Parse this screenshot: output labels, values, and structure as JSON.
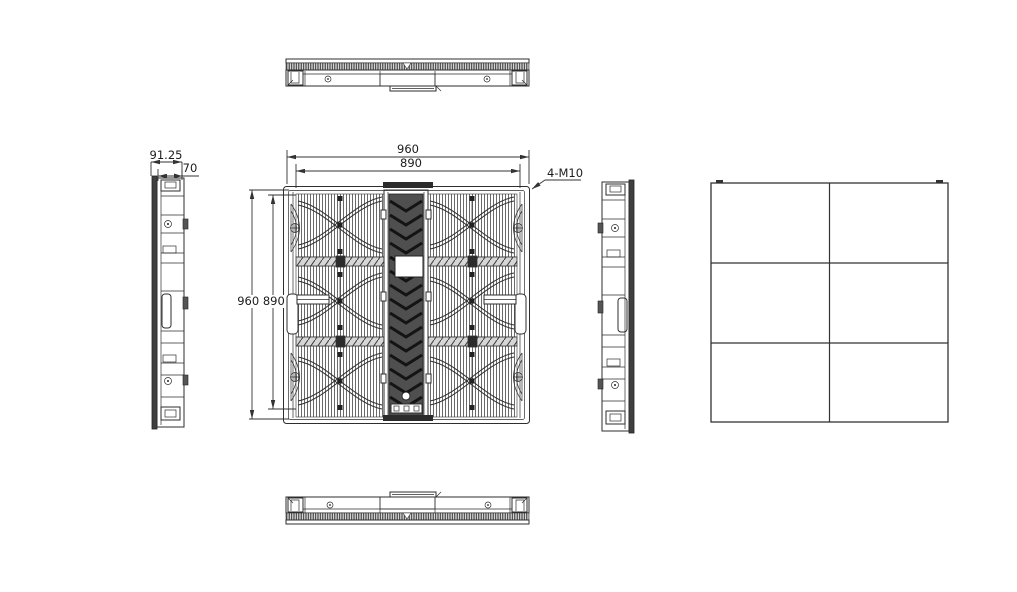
{
  "drawing": {
    "background": "#ffffff",
    "line_color": "#2e2e2e",
    "annotations": {
      "front_width_outer": "960",
      "front_width_inner": "890",
      "front_height_pair": "960 890",
      "mount_callout": "4-M10",
      "side_depth_overall": "91.25",
      "side_depth_body": "70"
    },
    "rear_view": {
      "rows": 3,
      "columns": 2
    }
  }
}
